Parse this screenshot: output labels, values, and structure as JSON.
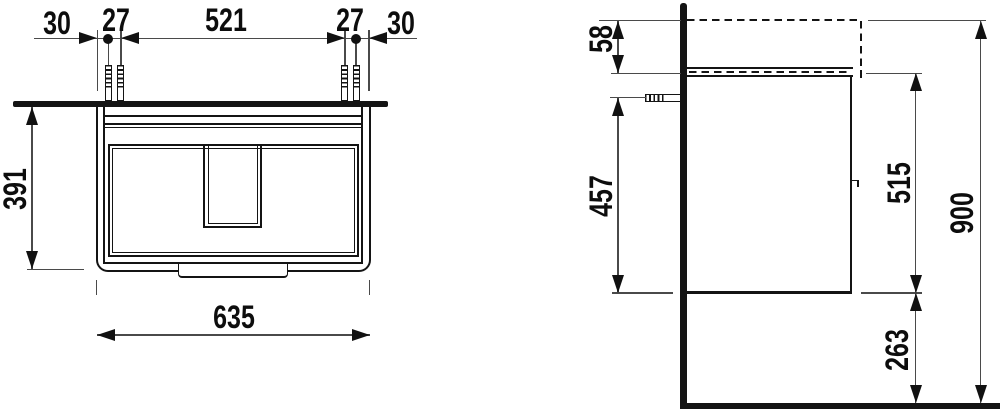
{
  "colors": {
    "line": "#141414",
    "dim_line": "#4a4a4a",
    "background": "#ffffff"
  },
  "front_view": {
    "dim_30_left": "30",
    "dim_27_left": "27",
    "dim_521": "521",
    "dim_27_right": "27",
    "dim_30_right": "30",
    "dim_391": "391",
    "dim_635": "635"
  },
  "side_view": {
    "dim_58": "58",
    "dim_457": "457",
    "dim_515": "515",
    "dim_263": "263",
    "dim_900": "900"
  }
}
